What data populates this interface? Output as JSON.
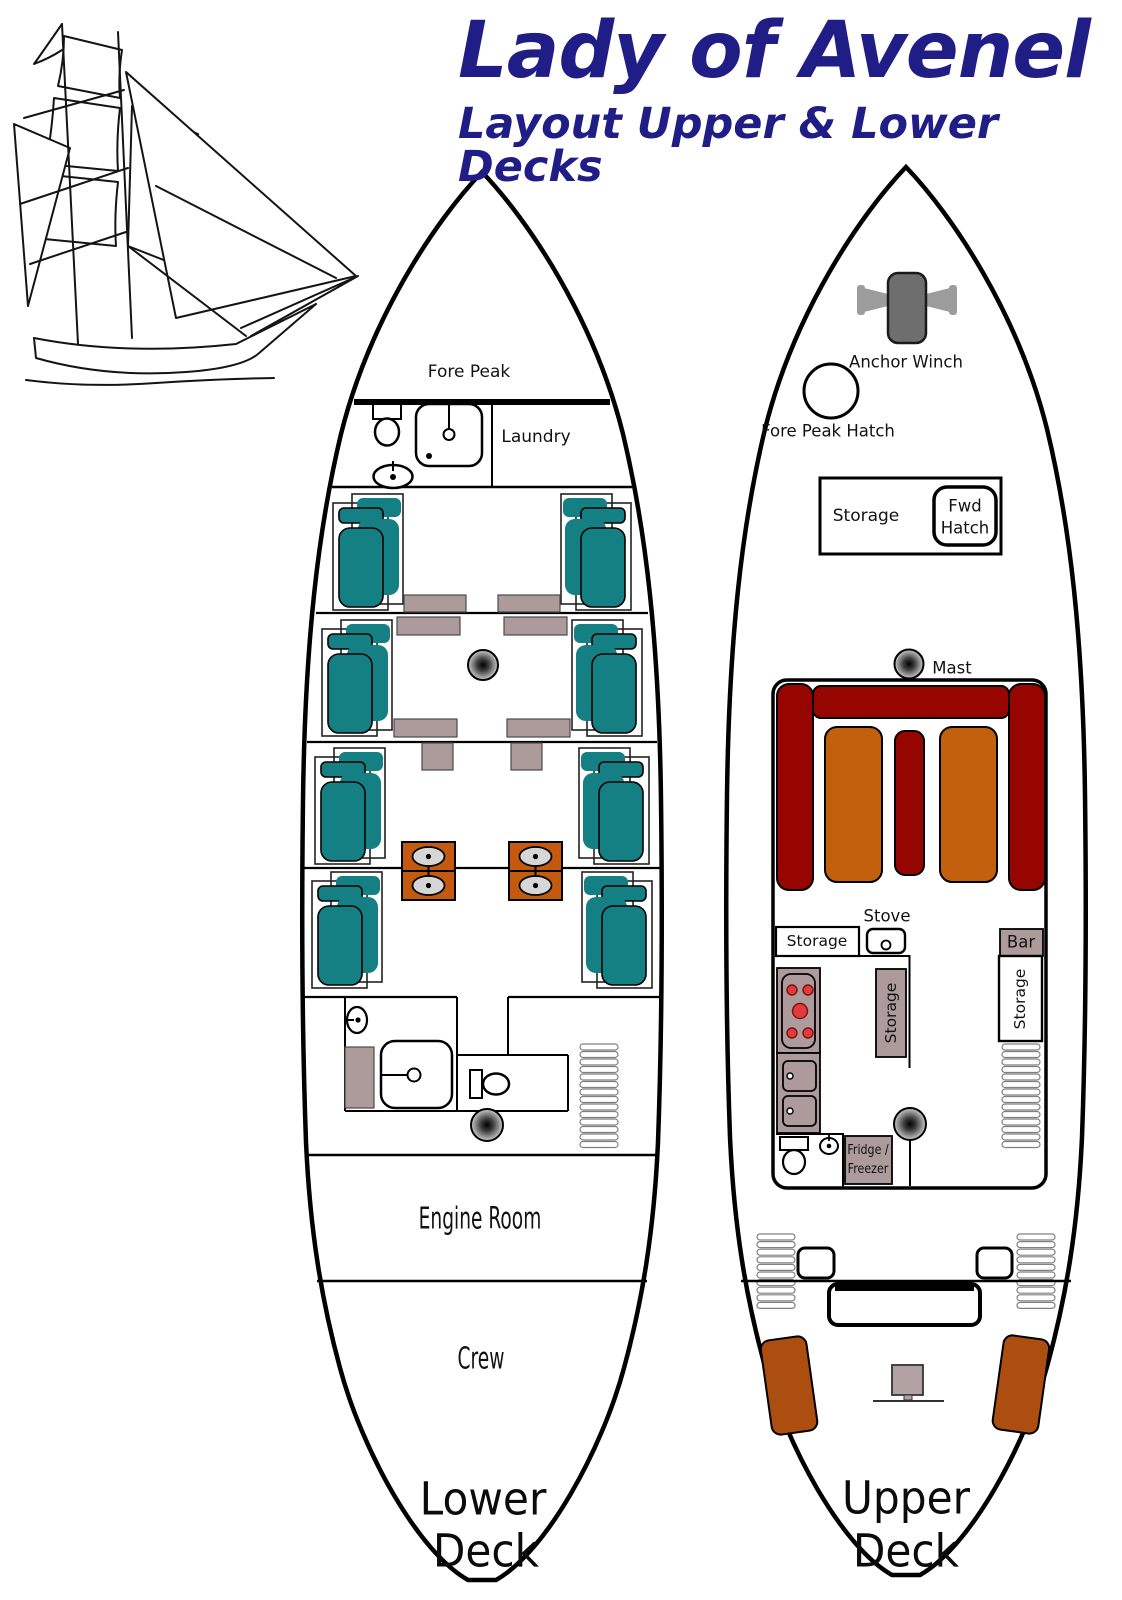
{
  "header": {
    "title": "Lady of Avenel",
    "subtitle": "Layout Upper & Lower Decks"
  },
  "colors": {
    "title_navy": "#201D86",
    "teal": "#148083",
    "mauve": "#AD9A9A",
    "maroon": "#970500",
    "orange_table": "#C2600D",
    "orange_washstand": "#C45A10",
    "brown_bench": "#AC4E0F",
    "winch_gray": "#6E6E6E",
    "handle_gray": "#9C9C9C",
    "burner_red": "#E23B3B",
    "sink_gray": "#D6D6D6",
    "binnacle_gray": "#B3A2A2"
  },
  "lower_deck": {
    "rooms": {
      "fore_peak": "Fore Peak",
      "laundry": "Laundry",
      "engine_room": "Engine Room",
      "crew": "Crew"
    },
    "deck_name": [
      "Lower",
      "Deck"
    ]
  },
  "upper_deck": {
    "labels": {
      "anchor_winch": "Anchor Winch",
      "fore_peak_hatch": "Fore Peak Hatch",
      "storage_forward": "Storage",
      "fwd_hatch": [
        "Fwd",
        "Hatch"
      ],
      "mast": "Mast",
      "stove": "Stove",
      "storage_galley": "Storage",
      "storage_mid": "Storage",
      "bar": "Bar",
      "storage_bar_side": "Storage",
      "fridge_freezer": [
        "Fridge /",
        "Freezer"
      ]
    },
    "deck_name": [
      "Upper",
      "Deck"
    ]
  }
}
